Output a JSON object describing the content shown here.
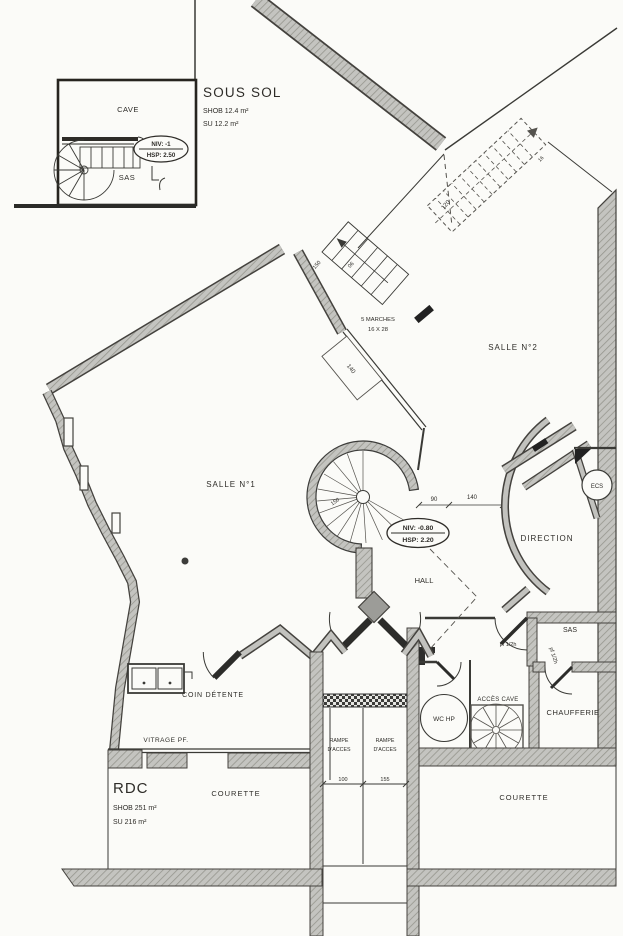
{
  "inset": {
    "title": "SOUS SOL",
    "shob": "SHOB 12.4 m²",
    "su": "SU 12.2 m²",
    "cave": "CAVE",
    "sas": "SAS",
    "niv": "NIV: -1",
    "hsp": "HSP: 2.50"
  },
  "plan": {
    "salle1": "SALLE N°1",
    "salle2": "SALLE N°2",
    "direction": "DIRECTION",
    "hall": "HALL",
    "sas": "SAS",
    "ecs": "ECS",
    "wc": "WC HP",
    "acces_cave": "ACCÈS CAVE",
    "chaufferie": "CHAUFFERIE",
    "coin_detente": "COIN DÉTENTE",
    "vitrage": "VITRAGE PF.",
    "rdc": "RDC",
    "shob": "SHOB 251 m²",
    "su": "SU 216 m²",
    "courette_left": "COURETTE",
    "courette_right": "COURETTE",
    "rampe_line1": "RAMPE",
    "rampe_line2": "D'ACCES",
    "stair_note1": "5 MARCHES",
    "stair_note2": "16 X 28",
    "niv": "NIV: -0.80",
    "hsp": "HSP: 2.20",
    "pf1": "pf 1/2h",
    "pf2": "pf 1/2h"
  },
  "dims": {
    "d90": "90",
    "d140": "140",
    "d140b": "140",
    "d150": "150",
    "d150b": "150",
    "d120": "120",
    "d100": "100",
    "d155": "155",
    "d06": "06",
    "d16": "16"
  },
  "colors": {
    "paper": "#fbfbf8",
    "ink": "#2e2c28",
    "wall_gray": "#c4c4c0"
  }
}
